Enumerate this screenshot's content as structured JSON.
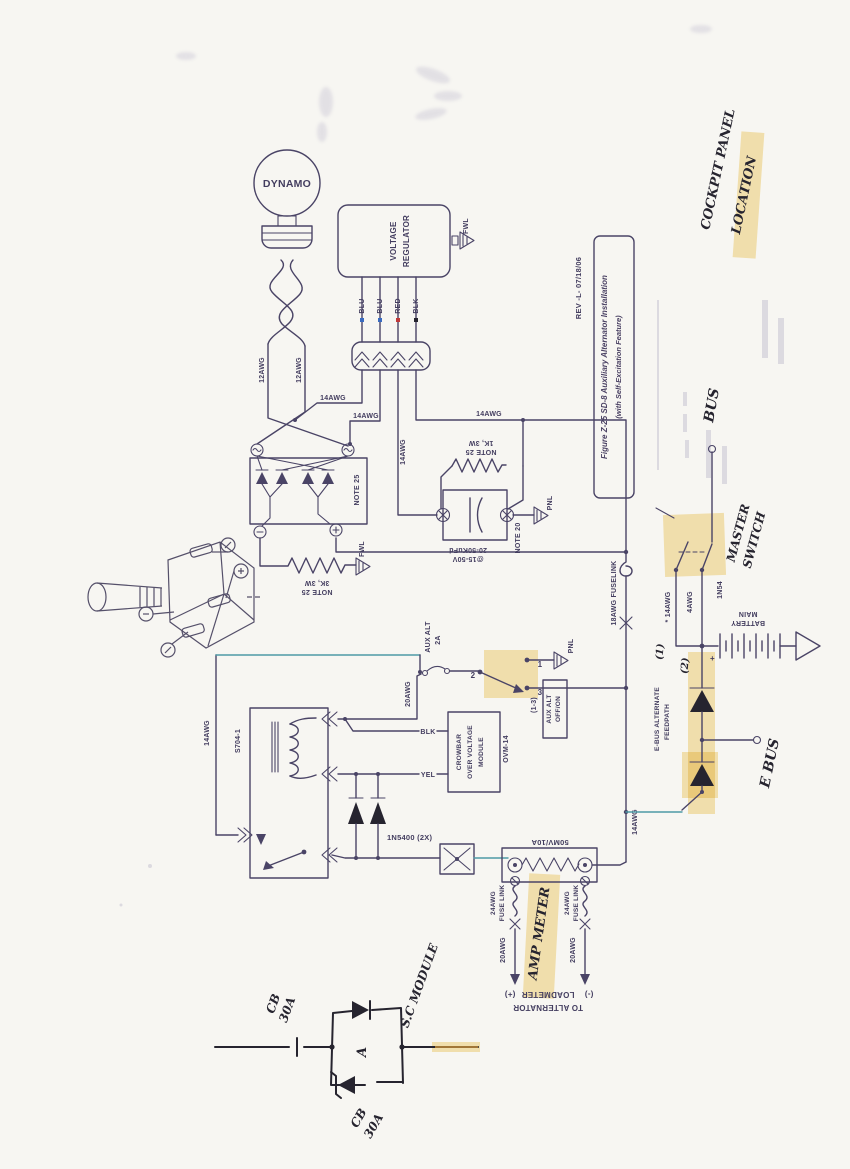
{
  "title_block": {
    "rev": "REV  -L-  07/18/06",
    "title_line1": "Figure Z-25  SD-8 Auxiliary Alternator Installation",
    "title_line2": "(with Self-Excitation Feature)"
  },
  "handwritten": {
    "cockpit_panel": "COCKPIT PANEL",
    "location": "LOCATION",
    "bus": "BUS",
    "master_switch": [
      "MASTER",
      "SWITCH"
    ],
    "e_bus": "E BUS",
    "amp_meter": "AMP METER",
    "sc_module": "S.C MODULE",
    "cb_upper": [
      "CB",
      "30A"
    ],
    "cb_lower": [
      "CB",
      "30A"
    ],
    "feed1": "(1)",
    "feed2": "(2)",
    "module_a": "A"
  },
  "components": {
    "dynamo": "DYNAMO",
    "voltage_regulator": [
      "VOLTAGE",
      "REGULATOR"
    ],
    "bridge_note": "NOTE 25",
    "resistor_1k": [
      "1K, 3W",
      "NOTE 25"
    ],
    "resistor_3k": [
      "3K, 3W",
      "NOTE 25"
    ],
    "capacitor": [
      "20-50KuFd",
      "@15-50V"
    ],
    "capacitor_note": "NOTE 20",
    "relay_part_no": "S704-1",
    "crowbar_module": [
      "CROWBAR",
      "OVER VOLTAGE",
      "MODULE"
    ],
    "crowbar_part_no": "OVM-14",
    "suppression_diodes": "1N5400 (2X)",
    "diode_1n54": "1N54",
    "main_battery": [
      "MAIN",
      "BATTERY"
    ],
    "battery_plus": "+",
    "shunt_rating": "50MV/10A",
    "aux_alt_breaker": [
      "AUX ALT",
      "2A"
    ],
    "aux_alt_switch": [
      "AUX ALT",
      "OFF/ON"
    ],
    "aux_alt_switch_pos": "(1-3)",
    "ebus_feedpath": [
      "E-BUS ALTERNATE",
      "FEEDPATH"
    ],
    "sw1": "1",
    "sw2": "2",
    "sw3": "3"
  },
  "wires": {
    "w12_left": "12AWG",
    "w12_right": "12AWG",
    "w14_a": "14AWG",
    "w14_b": "14AWG",
    "w14_c": "14AWG",
    "w14_d": "14AWG",
    "w14_relay": "14AWG",
    "w14_star": "* 14AWG",
    "w14_blead": "14AWG",
    "w4": "4AWG",
    "w20_coil": "20AWG",
    "w18_fuselink": "18AWG  FUSELINK",
    "fuse_link_left": [
      "24AWG",
      "FUSE LINK"
    ],
    "fuse_link_right": [
      "24AWG",
      "FUSE LINK"
    ],
    "w20_left": "20AWG",
    "w20_right": "20AWG",
    "vr_blu1": "BLU",
    "vr_blu2": "BLU",
    "vr_red": "RED",
    "vr_blk": "BLK",
    "crowbar_blk": "BLK",
    "crowbar_yel": "YEL"
  },
  "grounds": {
    "fwl_vr": "FWL",
    "fwl_res": "FWL",
    "pnl_cap": "PNL",
    "pnl_sw": "PNL"
  },
  "loadmeter": {
    "to_alternator": "TO ALTERNATOR",
    "loadmeter": "LOADMETER",
    "plus": "(+)",
    "minus": "(-)"
  },
  "colors": {
    "ink": "#4a4466",
    "pen": "#26242f",
    "highlight": "#f2cf6b",
    "cyan": "#4e9aa6",
    "paper": "#f7f6f2"
  }
}
